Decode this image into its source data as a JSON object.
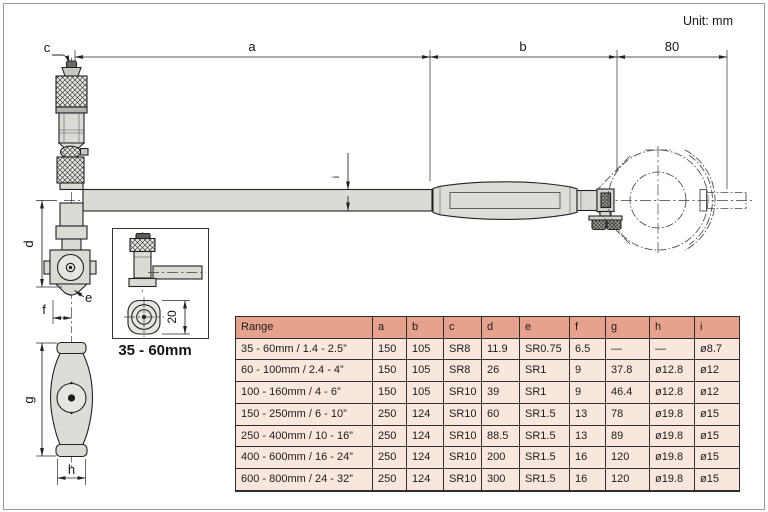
{
  "unit_label": "Unit: mm",
  "drawing": {
    "dim_labels": {
      "a": "a",
      "b": "b",
      "c": "c",
      "d": "d",
      "e": "e",
      "f": "f",
      "g": "g",
      "h": "h",
      "i": "i",
      "right_length": "80",
      "inset_height": "20"
    },
    "inset_caption": "35 - 60mm"
  },
  "table": {
    "columns": [
      "Range",
      "a",
      "b",
      "c",
      "d",
      "e",
      "f",
      "g",
      "h",
      "i"
    ],
    "rows": [
      [
        "35 - 60mm / 1.4 - 2.5”",
        "150",
        "105",
        "SR8",
        "11.9",
        "SR0.75",
        "6.5",
        "—",
        "—",
        "ø8.7"
      ],
      [
        "60 - 100mm / 2.4 - 4”",
        "150",
        "105",
        "SR8",
        "26",
        "SR1",
        "9",
        "37.8",
        "ø12.8",
        "ø12"
      ],
      [
        "100 - 160mm / 4 - 6”",
        "150",
        "105",
        "SR10",
        "39",
        "SR1",
        "9",
        "46.4",
        "ø12.8",
        "ø12"
      ],
      [
        "150 - 250mm / 6 - 10”",
        "250",
        "124",
        "SR10",
        "60",
        "SR1.5",
        "13",
        "78",
        "ø19.8",
        "ø15"
      ],
      [
        "250 - 400mm / 10 - 16”",
        "250",
        "124",
        "SR10",
        "88.5",
        "SR1.5",
        "13",
        "89",
        "ø19.8",
        "ø15"
      ],
      [
        "400 - 600mm / 16 - 24”",
        "250",
        "124",
        "SR10",
        "200",
        "SR1.5",
        "16",
        "120",
        "ø19.8",
        "ø15"
      ],
      [
        "600 - 800mm / 24 - 32”",
        "250",
        "124",
        "SR10",
        "300",
        "SR1.5",
        "16",
        "120",
        "ø19.8",
        "ø15"
      ]
    ]
  },
  "colors": {
    "table_header_bg": "#e6a28d",
    "table_row_bg": "#f9e7de",
    "drawing_line": "#222222",
    "metal_fill": "#dcdad4",
    "page_border": "#9a9a9a"
  }
}
